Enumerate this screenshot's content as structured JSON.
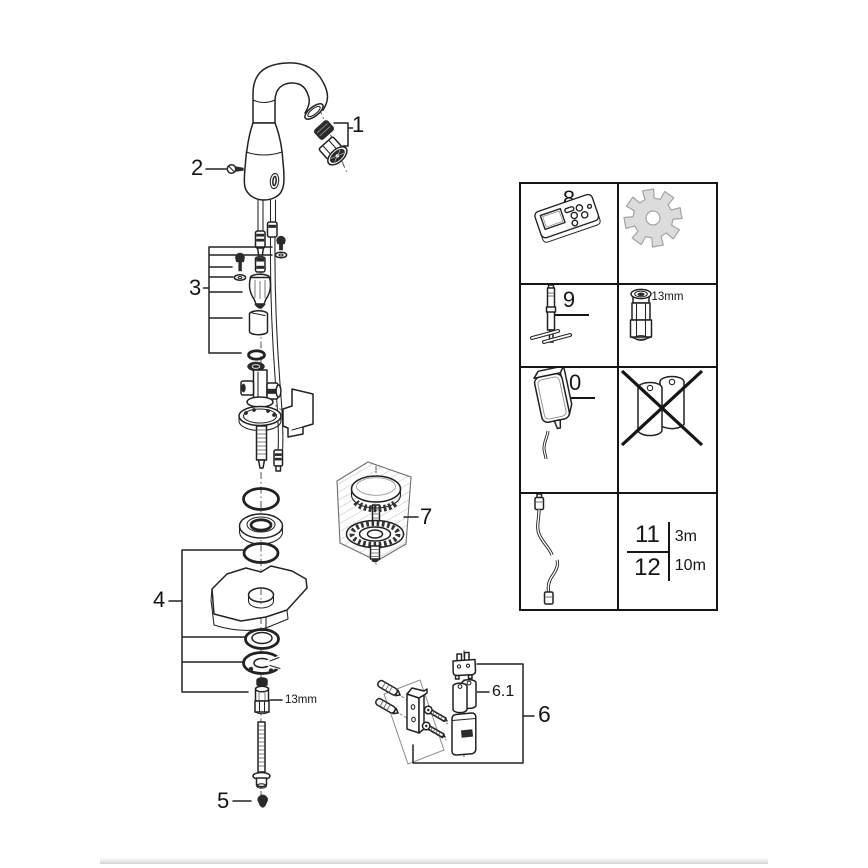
{
  "callouts": {
    "p1": "1",
    "p2": "2",
    "p3": "3",
    "p4": "4",
    "p5": "5",
    "p6": "6",
    "p6_1": "6.1",
    "p7": "7",
    "rod_wrench_size": "13mm"
  },
  "parts_table": {
    "item8_label": "8",
    "item9_label": "9",
    "item10_label": "10",
    "item11_label": "11",
    "item12_label": "12",
    "item11_length": "3m",
    "item12_length": "10m",
    "socket_size": "13mm",
    "icons": {
      "cell_8": "remote-control-icon",
      "cell_8b": "gear-icon",
      "cell_9": "mounting-tool-icon",
      "cell_9b": "socket-13mm-icon",
      "cell_10": "power-supply-icon",
      "cell_10b": "no-battery-icon",
      "cell_11_12": "extension-cable-icon"
    }
  },
  "colors": {
    "ink": "#222222",
    "gear_fill": "#dcdcdc",
    "hatch": "#c9c9c9",
    "footer_bar": "#d3d3d3"
  }
}
